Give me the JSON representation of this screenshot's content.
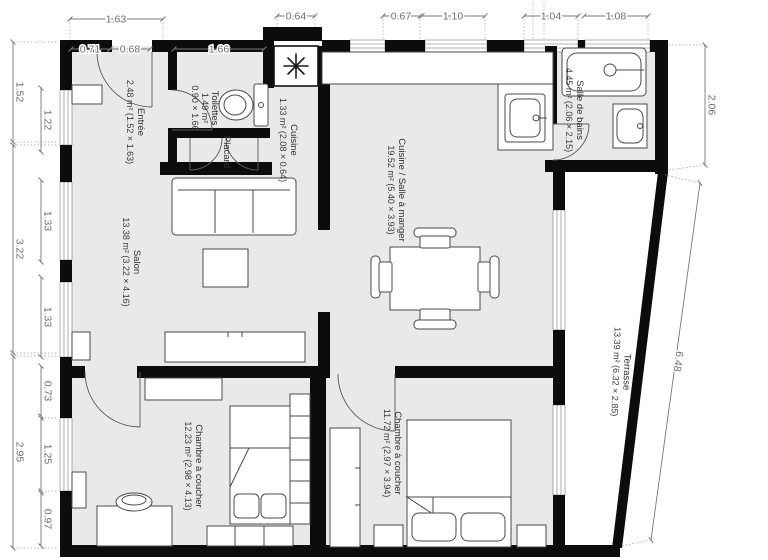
{
  "rooms": {
    "entree": {
      "name": "Entrée",
      "area": "2.48 m² (1.52 × 1.63)"
    },
    "toilettes": {
      "name": "Toilettes",
      "area": "1.49 m²",
      "dims": "0.90 × 1.66"
    },
    "placard": {
      "name": "Placard"
    },
    "cuisine": {
      "name": "Cuisine",
      "area": "1.33 m² (2.08 × 0.64)"
    },
    "salon": {
      "name": "Salon",
      "area": "13.38 m² (3.22 × 4.16)"
    },
    "salle_a_manger": {
      "name": "Cuisine / Salle à manger",
      "area": "19.52 m² (5.40 × 3.93)"
    },
    "salle_de_bains": {
      "name": "Salle de bains",
      "area": "4.45 m² (2.06 × 2.15)"
    },
    "terrasse": {
      "name": "Terrasse",
      "area": "13.39 m² (6.32 × 2.85)"
    },
    "chambre1": {
      "name": "Chambre à coucher",
      "area": "12.23 m² (2.98 × 4.13)"
    },
    "chambre2": {
      "name": "Chambre à coucher",
      "area": "11.72 m² (2.97 × 3.94)"
    }
  },
  "dimensions": {
    "top": [
      "1.63",
      "0.71",
      "0.68",
      "1.66",
      "0.64",
      "0.67",
      "1.10",
      "1.04",
      "1.08"
    ],
    "left": [
      "1.52",
      "1.22",
      "3.22",
      "1.33",
      "1.33",
      "2.95",
      "0.73",
      "1.25",
      "0.97"
    ],
    "right": [
      "2.06",
      "6.48"
    ]
  },
  "icons": {
    "fridge": "snowflake-icon",
    "faucets": "faucet-dot-icon"
  },
  "colors": {
    "wall": "#0c0c0c",
    "floor": "#e9e9e9",
    "terrace_floor": "#ffffff",
    "dimension": "#6e6e6e"
  }
}
